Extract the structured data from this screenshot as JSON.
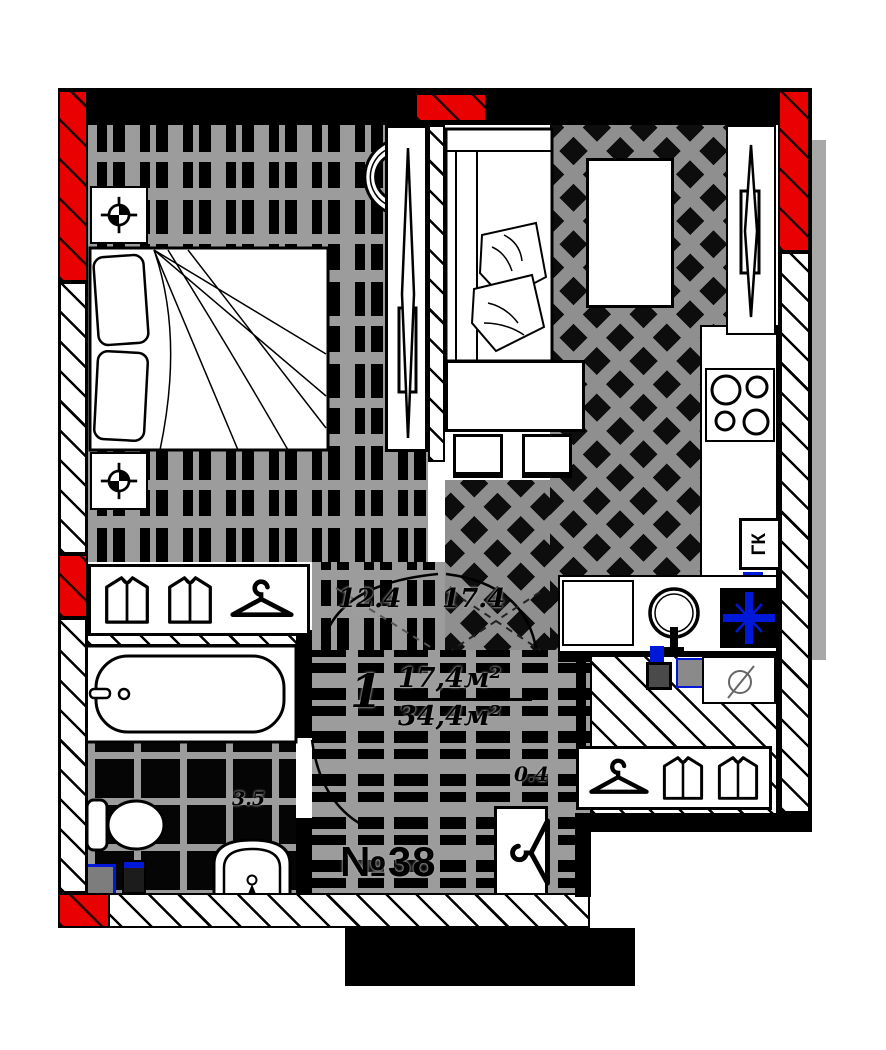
{
  "plan": {
    "apartment": {
      "number": "№38",
      "rooms_count": "1",
      "living_area": "17,4м²",
      "total_area": "34,4м²"
    },
    "rooms": {
      "bedroom_area": "12.4",
      "living_kitchen_area": "17.4",
      "bathroom_area": "3.5",
      "entry_dimension": "0.4"
    },
    "equipment": {
      "gas_boiler": "ГК"
    },
    "colors": {
      "highlight_wall_red": "#e90000",
      "plumbing_blue": "#0018d8",
      "wall_black": "#000000",
      "floor_gray": "#9c9c9c"
    },
    "icons": [
      "shirt-icon",
      "hanger-icon",
      "survey-target-icon",
      "sliding-door-icon",
      "stove-burners-icon",
      "sink-icon",
      "vent-cross-icon",
      "bathtub-icon",
      "toilet-icon",
      "washbasin-icon",
      "door-swing-arc"
    ]
  }
}
